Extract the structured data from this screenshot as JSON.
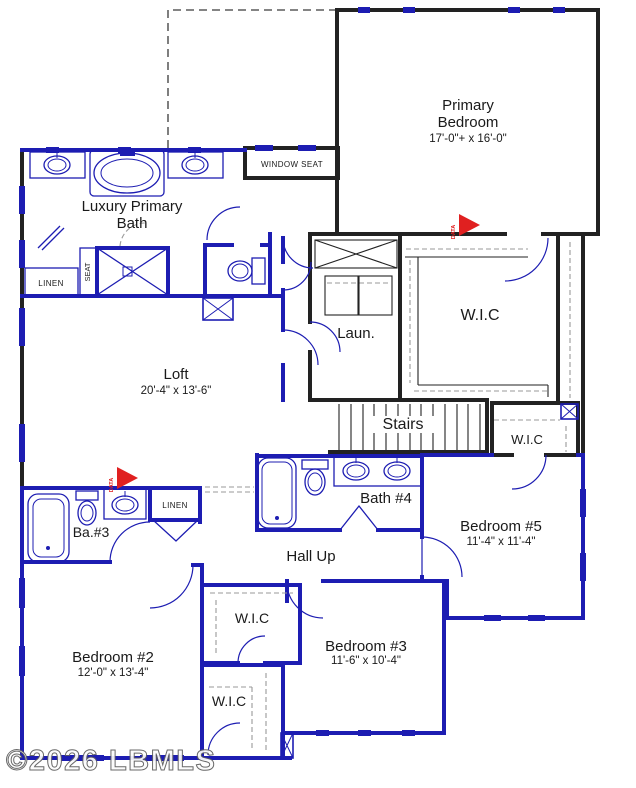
{
  "colors": {
    "wall_blue": "#1d1db2",
    "wall_black": "#222222",
    "text": "#1a1a1a",
    "data_red": "#e02020",
    "dash_gray": "#999999",
    "watermark_gray": "#5e5e5e"
  },
  "watermark": {
    "text": "©2026 LBMLS"
  },
  "markers": {
    "data_label": "DATA"
  },
  "rooms": {
    "primary_bedroom": {
      "name_line1": "Primary",
      "name_line2": "Bedroom",
      "dims": "17'-0\"+ x 16'-0\""
    },
    "luxury_primary_bath": {
      "name_line1": "Luxury Primary",
      "name_line2": "Bath"
    },
    "window_seat": {
      "name": "WINDOW SEAT"
    },
    "linen_upper": {
      "name": "LINEN"
    },
    "shower_seat": {
      "name": "SEAT"
    },
    "wic_primary": {
      "name": "W.I.C"
    },
    "laundry": {
      "name": "Laun."
    },
    "loft": {
      "name": "Loft",
      "dims": "20'-4\" x 13'-6\""
    },
    "stairs": {
      "name": "Stairs"
    },
    "wic_hall": {
      "name": "W.I.C"
    },
    "bath_4": {
      "name": "Bath #4"
    },
    "bedroom_5": {
      "name": "Bedroom #5",
      "dims": "11'-4\" x 11'-4\""
    },
    "bath_3": {
      "name": "Ba.#3"
    },
    "linen_lower": {
      "name": "LINEN"
    },
    "hall_up": {
      "name": "Hall Up"
    },
    "wic_bedroom3": {
      "name": "W.I.C"
    },
    "bedroom_3": {
      "name": "Bedroom #3",
      "dims": "11'-6\" x 10'-4\""
    },
    "bedroom_2": {
      "name": "Bedroom #2",
      "dims": "12'-0\" x 13'-4\""
    },
    "wic_bedroom2": {
      "name": "W.I.C"
    }
  }
}
